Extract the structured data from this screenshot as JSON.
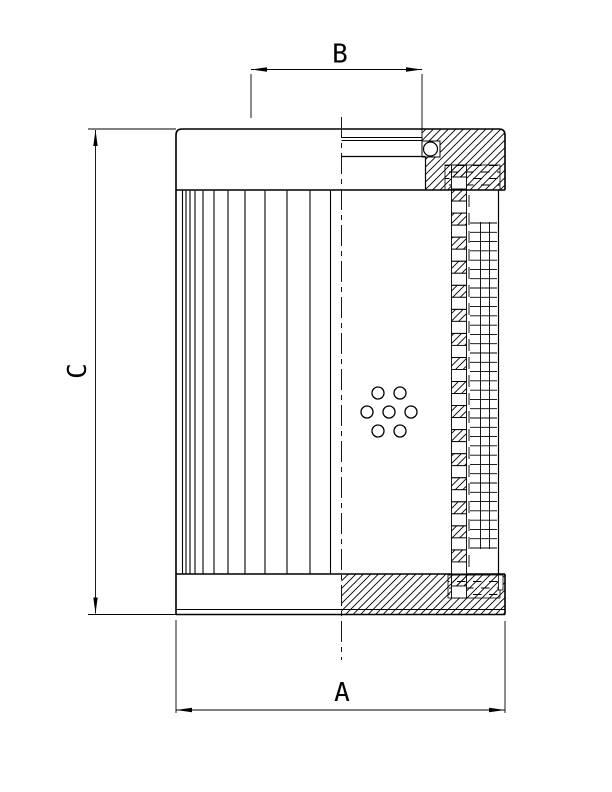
{
  "drawing": {
    "background_color": "#ffffff",
    "line_color": "#000000",
    "dimension_labels": {
      "width": "A",
      "port": "B",
      "height": "C"
    }
  }
}
